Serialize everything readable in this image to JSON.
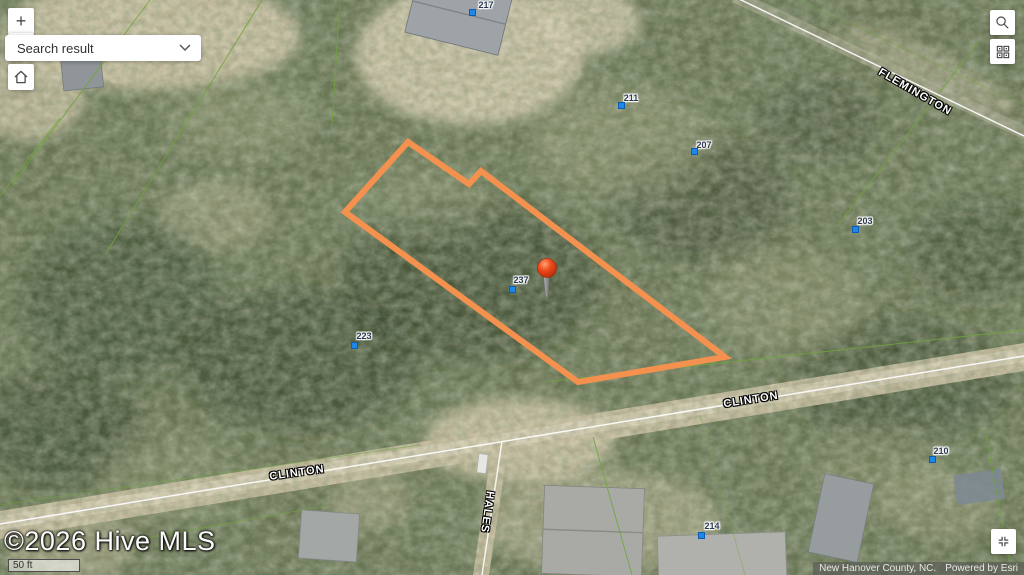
{
  "controls": {
    "zoom_in_label": "+",
    "search_dropdown_value": "Search result"
  },
  "icons": {
    "zoom_in": "plus-icon",
    "home": "home-icon",
    "search": "magnifier-icon",
    "qr": "qr-code-icon",
    "extent": "four-corners-icon",
    "dropdown": "chevron-down-icon"
  },
  "scale_bar": {
    "label": "50 ft"
  },
  "copyright": "©2026 Hive MLS",
  "attribution": {
    "source": "New Hanover County, NC.",
    "powered": "Powered by Esri"
  },
  "map": {
    "street_labels": [
      {
        "name": "FLEMINGTON"
      },
      {
        "name": "CLINTON"
      },
      {
        "name": "CLINTON"
      },
      {
        "name": "HALES"
      }
    ],
    "parcel_numbers": [
      {
        "label": "217"
      },
      {
        "label": "211"
      },
      {
        "label": "207"
      },
      {
        "label": "203"
      },
      {
        "label": "237"
      },
      {
        "label": "223"
      },
      {
        "label": "210"
      },
      {
        "label": "214"
      }
    ],
    "colors": {
      "highlight_outline": "#F4914E",
      "marker": "#E8431C",
      "parcel_point": "#1E88E5"
    }
  }
}
